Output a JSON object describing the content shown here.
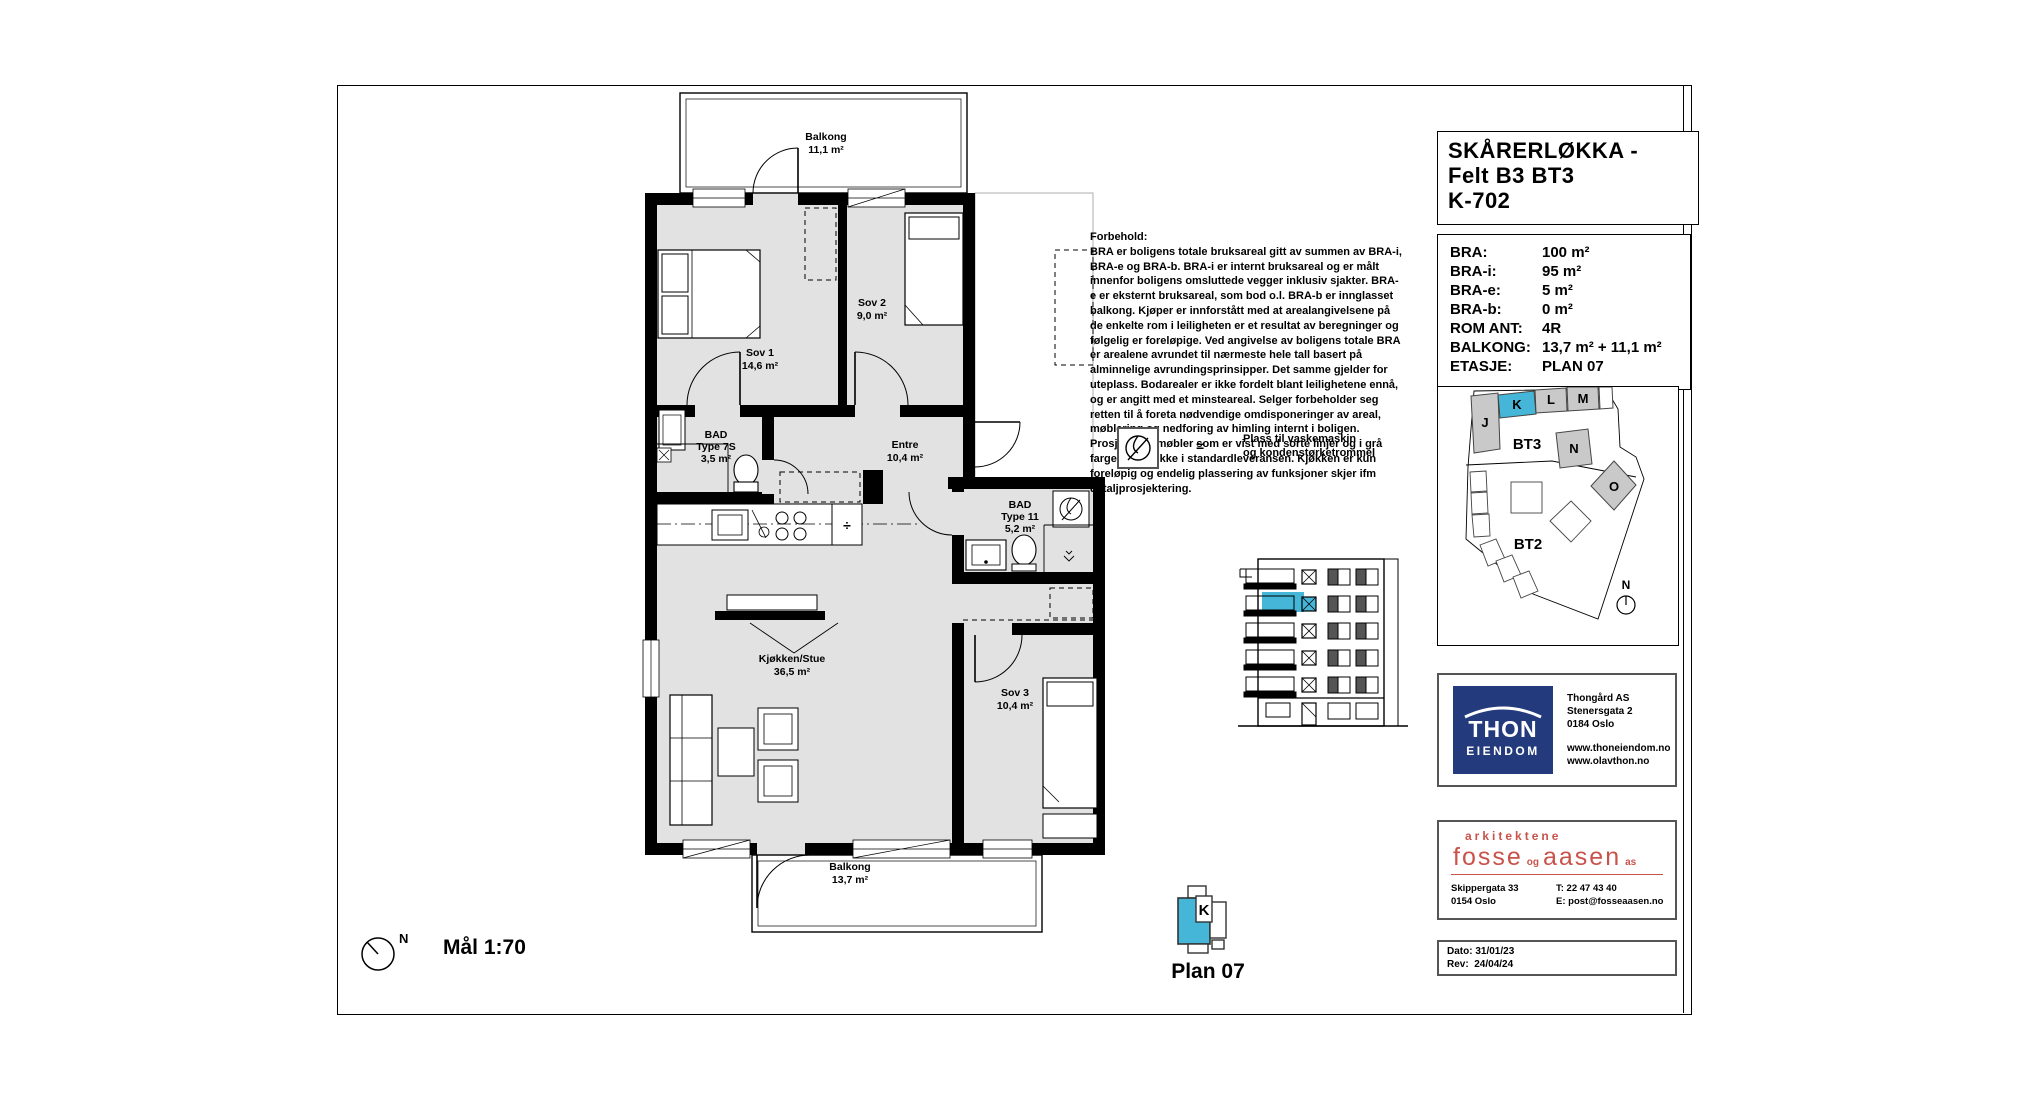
{
  "sheet": {
    "scale_label": "Mål 1:70",
    "north_label": "N",
    "plan_label": "Plan 07",
    "k_marker_label": "K"
  },
  "title_block": {
    "line1": "SKÅRERLØKKA -",
    "line2": "Felt B3 BT3",
    "line3": "K-702"
  },
  "info": {
    "rows": [
      {
        "label": "BRA:",
        "value": "100 m²"
      },
      {
        "label": "BRA-i:",
        "value": "95 m²"
      },
      {
        "label": "BRA-e:",
        "value": "5 m²"
      },
      {
        "label": "BRA-b:",
        "value": "0 m²"
      },
      {
        "label": "ROM ANT:",
        "value": "4R"
      },
      {
        "label": "BALKONG:",
        "value": "13,7 m² + 11,1 m²"
      },
      {
        "label": "ETASJE:",
        "value": "PLAN 07"
      }
    ]
  },
  "site": {
    "labels": {
      "j": "J",
      "k": "K",
      "l": "L",
      "m": "M",
      "n": "N",
      "o": "O",
      "bt3": "BT3",
      "bt2": "BT2",
      "north": "N"
    },
    "highlight_color": "#45b6d8"
  },
  "forbehold": {
    "title": "Forbehold:",
    "body": "BRA er boligens totale bruksareal gitt av summen av BRA-i, BRA-e og BRA-b. BRA-i er internt bruksareal og er målt innenfor boligens omsluttede vegger inklusiv sjakter. BRA-e er eksternt bruksareal, som bod o.l. BRA-b er innglasset balkong. Kjøper er innforstått med at arealangivelsene på de enkelte rom i leiligheten er et resultat av beregninger og følgelig er foreløpige. Ved angivelse av boligens totale BRA er arealene avrundet til nærmeste hele tall basert på alminnelige avrundingsprinsipper. Det samme gjelder for uteplass. Bodarealer er ikke fordelt blant leilighetene ennå, og er angitt med et minsteareal. Selger forbeholder seg retten til å foreta nødvendige omdisponeringer av areal, møblering og nedforing av himling internt i boligen. Prosjekterte møbler som er vist med sorte linjer og i grå farge inngår ikke i standardleveransen. Kjøkken er kun foreløpig og endelig plassering av funksjoner skjer ifm detaljprosjektering."
  },
  "legend": {
    "equals": "=",
    "line1": "Plass til vaskemaskin",
    "line2": "og kondenstørketrommel"
  },
  "rooms": {
    "balkong_top": {
      "name": "Balkong",
      "area": "11,1 m²"
    },
    "sov1": {
      "name": "Sov 1",
      "area": "14,6 m²"
    },
    "sov2": {
      "name": "Sov 2",
      "area": "9,0 m²"
    },
    "bad1": {
      "name": "BAD",
      "type": "Type 7S",
      "area": "3,5 m²"
    },
    "entre": {
      "name": "Entre",
      "area": "10,4 m²"
    },
    "bad2": {
      "name": "BAD",
      "type": "Type 11",
      "area": "5,2 m²"
    },
    "stue": {
      "name": "Kjøkken/Stue",
      "area": "36,5 m²"
    },
    "sov3": {
      "name": "Sov 3",
      "area": "10,4 m²"
    },
    "balkong_bottom": {
      "name": "Balkong",
      "area": "13,7 m²"
    },
    "kitchen_symbol": "÷"
  },
  "thon": {
    "name_top": "THON",
    "name_bottom": "EIENDOM",
    "company": "Thongård AS",
    "street": "Stenersgata 2",
    "city": "0184 Oslo",
    "web1": "www.thoneiendom.no",
    "web2": "www.olavthon.no",
    "brand_color": "#233a7d"
  },
  "architect": {
    "tagline": "arkitektene",
    "logo_fosse": "fosse",
    "logo_og": "og",
    "logo_aasen": "aasen",
    "logo_as": "as",
    "street": "Skippergata 33",
    "city": "0154 Oslo",
    "phone": "T: 22 47 43 40",
    "email": "E: post@fosseaasen.no",
    "brand_color": "#c9524b"
  },
  "dates": {
    "dato_label": "Dato:",
    "dato": "31/01/23",
    "rev_label": "Rev:",
    "rev": "24/04/24"
  }
}
